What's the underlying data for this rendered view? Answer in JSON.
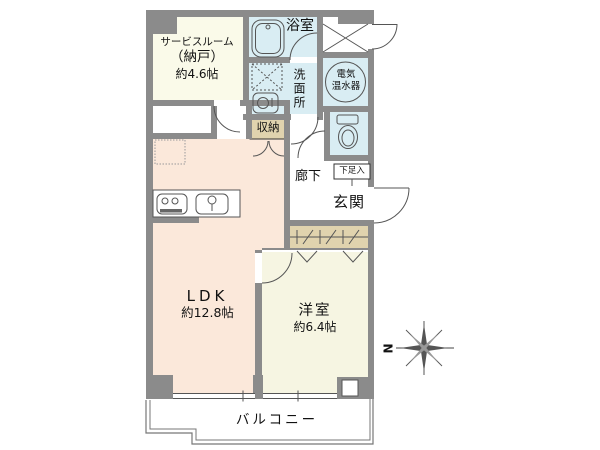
{
  "title": "マンション間取り図",
  "rooms": {
    "service": {
      "name": "サービスルーム",
      "alt": "（納戸）",
      "area": "約4.6帖"
    },
    "bathroom": {
      "name": "浴室"
    },
    "washroom": {
      "name": "洗面所"
    },
    "water_heater": {
      "line1": "電気",
      "line2": "温水器"
    },
    "storage": {
      "name": "収納"
    },
    "hallway": {
      "name": "廊下"
    },
    "shoe_cabinet": {
      "name": "下足入"
    },
    "entrance": {
      "name": "玄関"
    },
    "ldk": {
      "name": "LDK",
      "area": "約12.8帖"
    },
    "western": {
      "name": "洋室",
      "area": "約6.4帖"
    },
    "balcony": {
      "name": "バルコニー"
    }
  },
  "compass": {
    "north": "N"
  },
  "colors": {
    "wall": "#8b8b8b",
    "water": "#d9edf3",
    "ldk": "#fbe8da",
    "cream": "#fafae9",
    "cream2": "#f6f5e2",
    "tan": "#e0d3ae",
    "line": "#555555",
    "text": "#111111"
  }
}
